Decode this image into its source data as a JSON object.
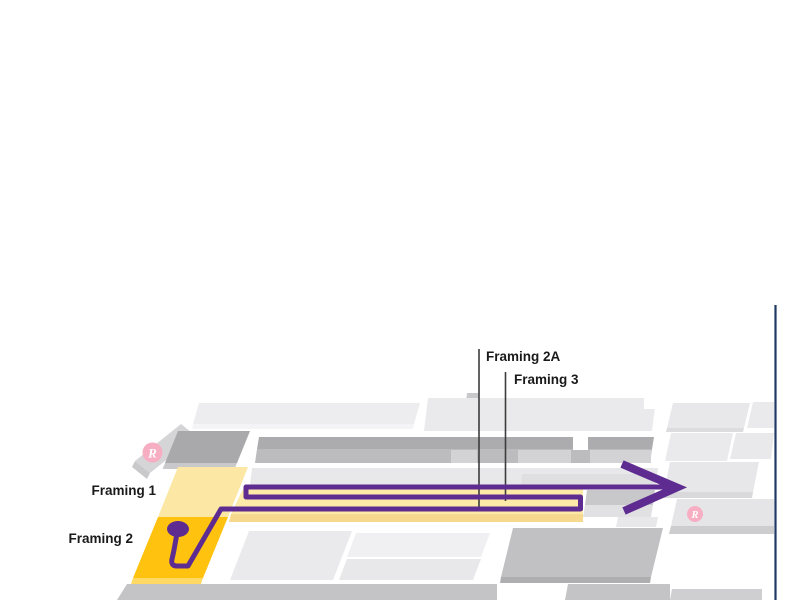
{
  "map": {
    "labels": {
      "framing1": "Framing 1",
      "framing2": "Framing 2",
      "framing2a": "Framing 2A",
      "framing3": "Framing 3"
    },
    "badges": {
      "restroom_left": "R",
      "restroom_right": "R"
    },
    "icons": {
      "route_start": "location-pin-icon",
      "route_end": "arrow-right-icon",
      "restroom": "restroom-badge-icon"
    },
    "colors": {
      "route": "#5E2C90",
      "highlight_gold": "#FFC20E",
      "highlight_gold_side": "#FFD964",
      "highlight_yellow": "#FCE8A4",
      "aisle_yellow": "#FDE9A8",
      "aisle_edge": "#F6D98E",
      "boundary_navy": "#1F3864",
      "badge_pink": "#F8AEC2",
      "label_text": "#1A1A1A"
    }
  }
}
